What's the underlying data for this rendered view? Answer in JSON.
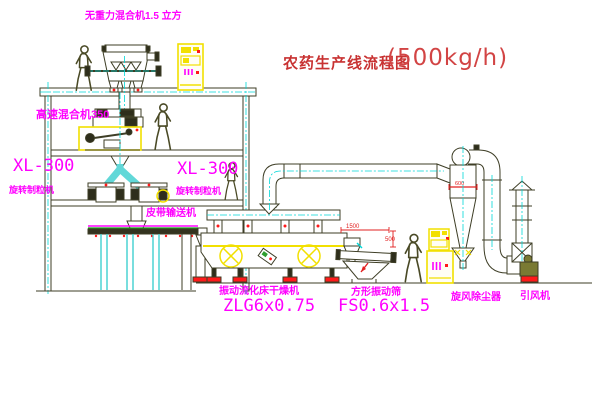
{
  "title": {
    "text": "农药生产线流程图",
    "capacity": "(500kg/h)"
  },
  "equipment_labels": {
    "gravity_mixer": "无重力混合机1.5 立方",
    "high_speed_mixer": "高速混合机350",
    "granulator_left": {
      "model": "XL-300",
      "name": "旋转制粒机"
    },
    "granulator_mid": {
      "model": "XL-300",
      "name": "旋转制粒机"
    },
    "belt_conveyor": "皮带输送机",
    "dryer": {
      "name": "振动流化床干燥机",
      "model": "ZLG6x0.75"
    },
    "sieve": {
      "name": "方形振动筛",
      "model": "FS0.6x1.5"
    },
    "cyclone": "旋风除尘器",
    "fan": "引风机"
  },
  "dimensions": {
    "sieve_length": "1500",
    "sieve_height": "500",
    "cyclone_inlet": "600"
  },
  "colors": {
    "label": "#ff00ff",
    "title_red": "#c83232",
    "centerline_cyan": "#00d8d8",
    "highlight_yellow": "#f2e000",
    "line_olive": "#3e3e26",
    "accent_red": "#ff1a1a"
  }
}
